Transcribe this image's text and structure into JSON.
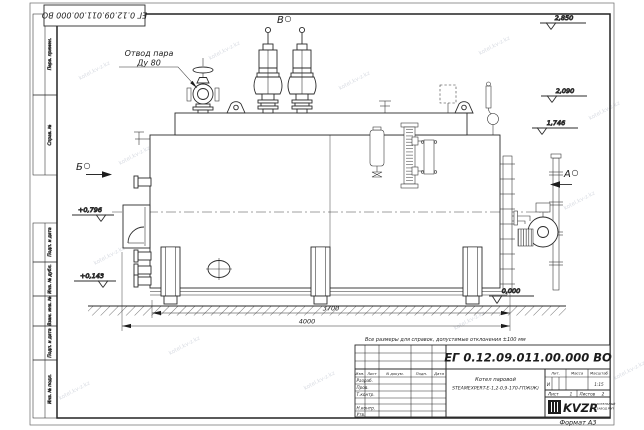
{
  "sheet": {
    "watermark": "kotel.kv-z.kz",
    "stamp_top": "ЕГ 0.12.09.011.00.000 ВО",
    "format_label": "Формат А3",
    "margins_top": [
      "Перв. примен.",
      "Справ. №"
    ],
    "margins_bottom": [
      "Подп. и дата",
      "Инв. № дубл.",
      "Взам. инв. №",
      "Подп. и дата",
      "Инв. № подл."
    ]
  },
  "views": {
    "a": "А",
    "b": "Б",
    "v": "В"
  },
  "callout": {
    "line1": "Отвод пара",
    "line2": "Ду 80"
  },
  "elevations": {
    "top": "2,850",
    "mid": "2,090",
    "low": "1,746",
    "left_upper": "+0,796",
    "left_lower": "+0,143",
    "ground": "0,000"
  },
  "dimensions": {
    "inner": "3700",
    "overall": "4000"
  },
  "note": "Все размеры для справок, допустимые отклонения ±100 мм",
  "title_block": {
    "doc_number": "ЕГ 0.12.09.011.00.000 ВО",
    "product_line1": "Котел паровой",
    "product_line2": "STEAMEXPERT-E-1,2-0,9-170-ГПЖ(Ж)",
    "col_izm": "Изм.",
    "col_list": "Лист",
    "col_doc": "N докум.",
    "col_sign": "Подп.",
    "col_date": "Дата",
    "row_razrab": "Разраб.",
    "row_prov": "Пров.",
    "row_tkontr": "Т.контр.",
    "row_nkontr": "Н.контр.",
    "row_utv": "Утв.",
    "lit_label": "Лит.",
    "mass_label": "Масса",
    "scale_label": "Масштаб",
    "lit_value": "И",
    "scale_value": "1:15",
    "sheet_label": "Лист",
    "sheet_num": "1",
    "sheets_label": "Листов",
    "sheets_num": "2",
    "company": "KVZR",
    "company_line1": "КОТЕЛЬНЫЙ",
    "company_line2": "ЗАВОД РЭП"
  }
}
